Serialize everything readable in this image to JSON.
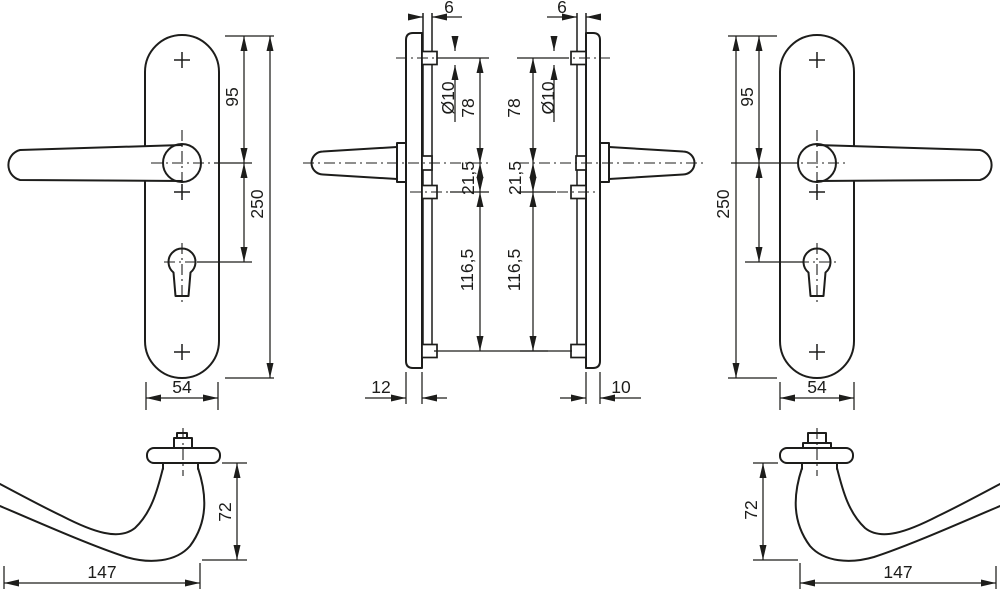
{
  "drawing": {
    "front_left": {
      "handle_to_top": "95",
      "plate_length": "250",
      "plate_width": "54"
    },
    "side_left": {
      "grip_offset": "6",
      "boss_diameter": "Ø10",
      "top_fix_to_handle": "78",
      "handle_to_mid_fix": "21,5",
      "mid_to_bottom_fix": "116,5",
      "plate_thickness": "12"
    },
    "side_right": {
      "grip_offset": "6",
      "boss_diameter": "Ø10",
      "top_fix_to_handle": "78",
      "handle_to_mid_fix": "21,5",
      "mid_to_bottom_fix": "116,5",
      "plate_thickness": "10"
    },
    "front_right": {
      "handle_to_top": "95",
      "plate_length": "250",
      "plate_width": "54"
    },
    "lever_left": {
      "height": "72",
      "length": "147"
    },
    "lever_right": {
      "height": "72",
      "length": "147"
    }
  },
  "colors": {
    "line": "#1d1d1b",
    "background": "#ffffff"
  }
}
